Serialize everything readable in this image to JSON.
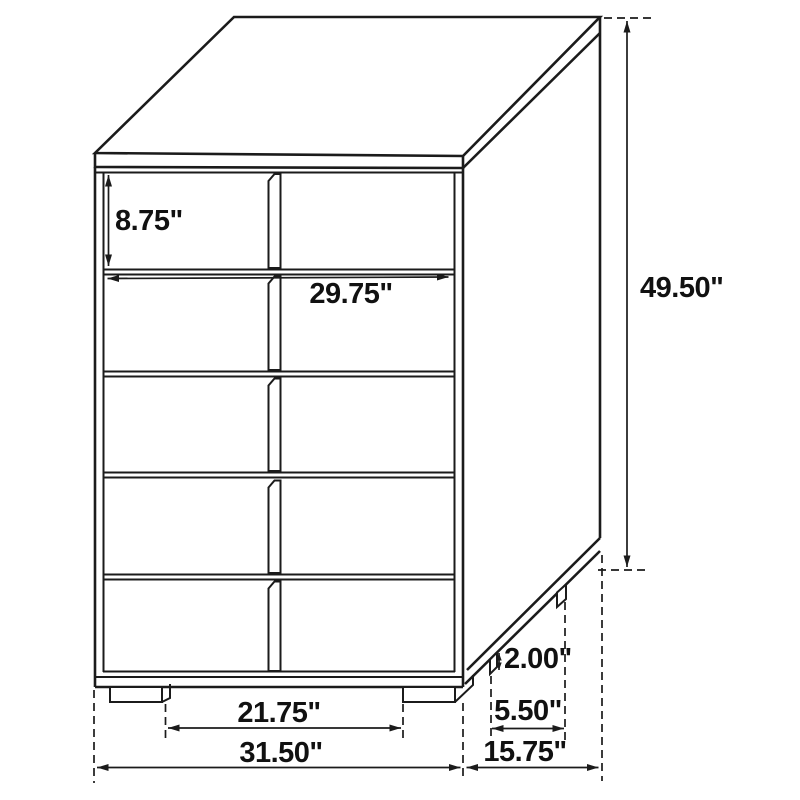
{
  "diagram_type": "furniture-dimension-line-drawing",
  "object": "five-drawer-two-column-chest",
  "colors": {
    "line": "#1b1b1b",
    "background": "#ffffff",
    "text": "#111111"
  },
  "dimensions": {
    "top_drawer_height": {
      "label": "8.75\"",
      "value": 8.75,
      "unit": "in"
    },
    "drawer_front_width": {
      "label": "29.75\"",
      "value": 29.75,
      "unit": "in"
    },
    "overall_height": {
      "label": "49.50\"",
      "value": 49.5,
      "unit": "in"
    },
    "leg_height": {
      "label": "2.00\"",
      "value": 2.0,
      "unit": "in"
    },
    "side_leg_spacing": {
      "label": "5.50\"",
      "value": 5.5,
      "unit": "in"
    },
    "front_leg_spacing": {
      "label": "21.75\"",
      "value": 21.75,
      "unit": "in"
    },
    "overall_width": {
      "label": "31.50\"",
      "value": 31.5,
      "unit": "in"
    },
    "overall_depth": {
      "label": "15.75\"",
      "value": 15.75,
      "unit": "in"
    }
  }
}
